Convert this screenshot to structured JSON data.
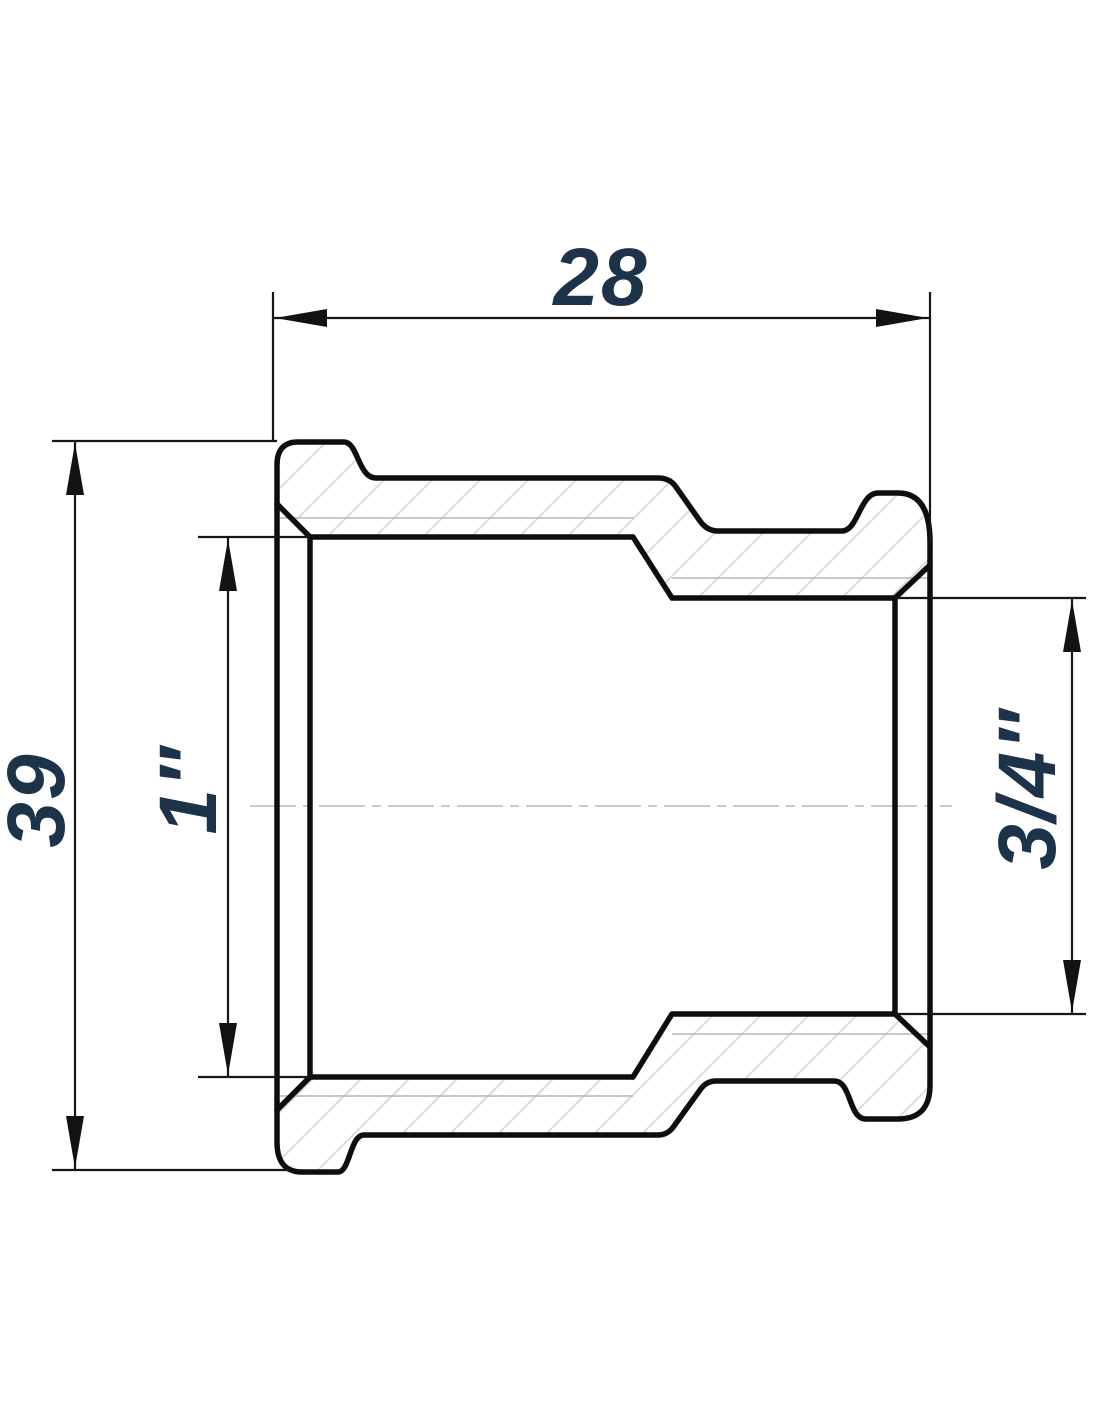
{
  "drawing": {
    "type": "technical-drawing",
    "subject": "reducing socket pipe fitting, full section view",
    "dimensions": {
      "width": {
        "label": "28"
      },
      "height": {
        "label": "39"
      },
      "left_thread": {
        "label": "1″"
      },
      "right_thread": {
        "label": "3/4″"
      }
    },
    "colors": {
      "ink": "#0e0e0e",
      "dimension_text": "#1d3349",
      "hatch": "#d8d8d8",
      "thread_line": "#c0c0c0",
      "centerline": "#c3c3c3",
      "background": "#ffffff"
    }
  }
}
